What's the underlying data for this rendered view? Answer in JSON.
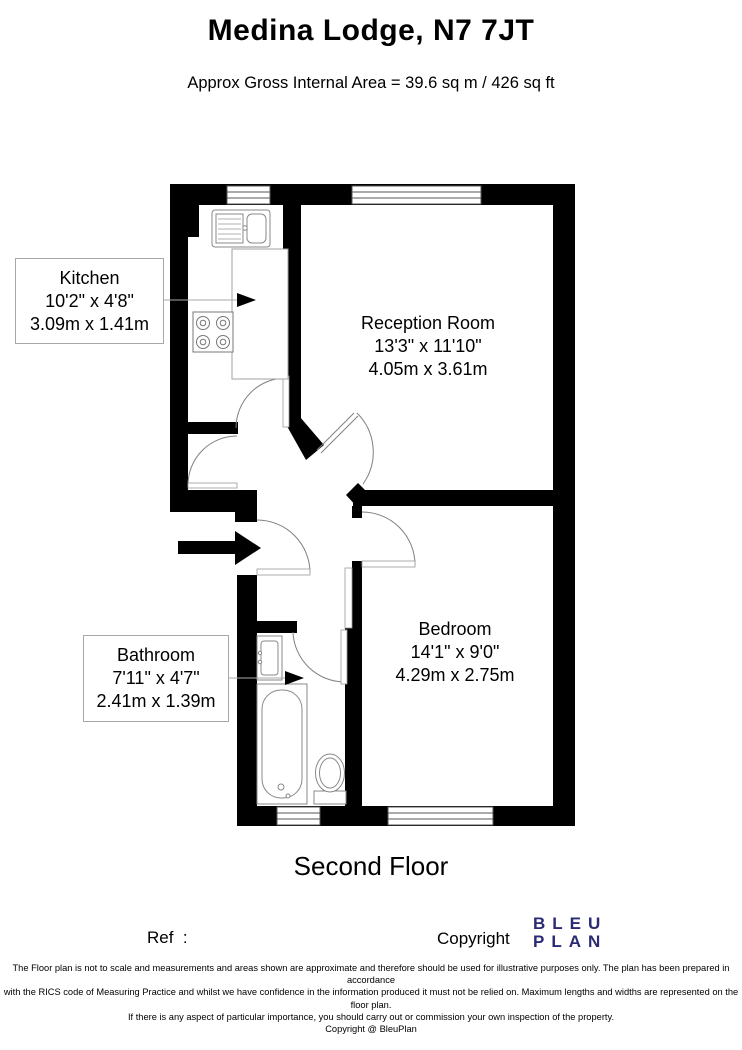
{
  "header": {
    "title": "Medina Lodge, N7 7JT",
    "subtitle": "Approx Gross Internal Area = 39.6 sq m / 426 sq ft"
  },
  "floor_plan": {
    "floor_label": "Second Floor",
    "rooms": {
      "kitchen": {
        "name": "Kitchen",
        "imperial": "10'2\" x 4'8\"",
        "metric": "3.09m x 1.41m"
      },
      "reception": {
        "name": "Reception Room",
        "imperial": "13'3\" x 11'10\"",
        "metric": "4.05m x 3.61m"
      },
      "bathroom": {
        "name": "Bathroom",
        "imperial": "7'11\" x 4'7\"",
        "metric": "2.41m x 1.39m"
      },
      "bedroom": {
        "name": "Bedroom",
        "imperial": "14'1\" x 9'0\"",
        "metric": "4.29m x 2.75m"
      }
    },
    "fixtures": [
      "kitchen-sink",
      "stove",
      "counter",
      "bathroom-sink",
      "bathtub",
      "toilet"
    ],
    "icons": [
      "entrance-arrow-icon",
      "kitchen-pointer-arrow-icon",
      "bathroom-pointer-arrow-icon"
    ],
    "wall_color": "#000000"
  },
  "footer": {
    "ref_label": "Ref  :",
    "copyright_label": "Copyright",
    "logo": {
      "line1": "BLEU",
      "line2": "PLAN",
      "color": "#2b2a74"
    },
    "disclaimer": [
      "The Floor plan is not to scale and measurements and areas shown are approximate and therefore should be used for illustrative purposes only. The plan has been prepared in accordance",
      "with the RICS code of Measuring Practice and whilst we have confidence in the information produced it must not be relied on. Maximum lengths and widths are represented on the floor plan.",
      "If there is any aspect of particular importance, you should carry out or commission your own inspection of the property.",
      "Copyright @ BleuPlan"
    ]
  }
}
